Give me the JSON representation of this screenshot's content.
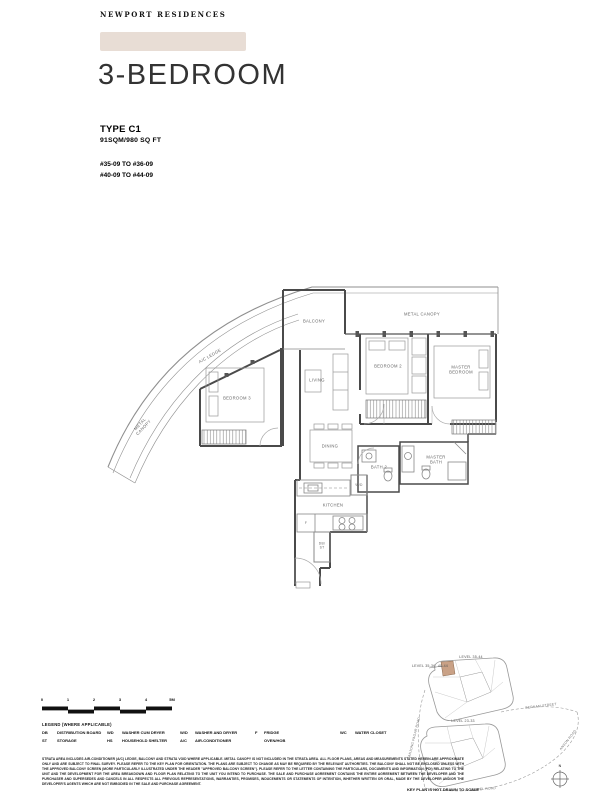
{
  "brand": {
    "logo": "NEWPORT RESIDENCES"
  },
  "header": {
    "title": "3-BEDROOM",
    "type_label": "TYPE C1",
    "area": "91SQM/980 SQ FT",
    "unit_range_1": "#35-09 TO #36-09",
    "unit_range_2": "#40-09 TO #44-09"
  },
  "plan": {
    "rooms": {
      "balcony": "BALCONY",
      "metal_canopy_top": "METAL CANOPY",
      "ac_ledge": "A/C LEDGE",
      "metal_canopy_left": "METAL CANOPY",
      "living": "LIVING",
      "bedroom_3": "BEDROOM 3",
      "bedroom_2": "BEDROOM 2",
      "master_bedroom": "MASTER BEDROOM",
      "dining": "DINING",
      "bath_2": "BATH 2",
      "master_bath": "MASTER BATH",
      "kitchen": "KITCHEN",
      "washer_dryer": "W/D",
      "fridge": "F",
      "db_st": "DB/ ST"
    }
  },
  "key_plan": {
    "level_top": "LEVEL 35-44",
    "level_highlight": "LEVEL 35-36, 40-44",
    "level_bottom": "LEVEL 23-33",
    "road_bernam": "BERNAM STREET",
    "road_anson": "ANSON ROAD",
    "road_keppel": "KEPPEL ROAD",
    "road_tanjong": "TANJONG PAGAR ROAD",
    "compass": "N",
    "caption": "KEY PLAN IS NOT DRAWN TO SCALE"
  },
  "scale_bar": {
    "ticks": [
      "0",
      "1",
      "2",
      "3",
      "4",
      "5M"
    ]
  },
  "legend": {
    "title": "LEGEND (WHERE APPLICABLE)",
    "entries": [
      {
        "abbr": "DB",
        "label": "DISTRIBUTION BOARD"
      },
      {
        "abbr": "ST",
        "label": "STORAGE"
      },
      {
        "abbr": "WD",
        "label": "WASHER CUM DRYER"
      },
      {
        "abbr": "HS",
        "label": "HOUSEHOLD SHELTER"
      },
      {
        "abbr": "W/D",
        "label": "WASHER AND DRYER"
      },
      {
        "abbr": "A/C",
        "label": "AIR-CONDITIONER"
      },
      {
        "abbr": "F",
        "label": "FRIDGE"
      },
      {
        "abbr": "",
        "label": "OVEN/HOB"
      },
      {
        "abbr": "WC",
        "label": "WATER CLOSET"
      }
    ]
  },
  "disclaimer": {
    "text": "STRATA AREA INCLUDES AIR-CONDITIONER (A/C) LEDGE, BALCONY AND STRATA VOID WHERE APPLICABLE. METAL CANOPY IS NOT INCLUDED IN THE STRATA AREA. ALL FLOOR PLANS, AREAS AND MEASUREMENTS STATED HEREIN ARE APPROXIMATE ONLY AND ARE SUBJECT TO FINAL SURVEY. PLEASE REFER TO THE KEY PLAN FOR ORIENTATION. THE PLANS ARE SUBJECT TO CHANGE AS MAY BE REQUIRED BY THE RELEVANT AUTHORITIES. THE BALCONY SHALL NOT BE ENCLOSED UNLESS WITH THE APPROVED BALCONY SCREEN (MORE PARTICULARLY ILLUSTRATED UNDER THE HEADER \"APPROVED BALCONY SCREEN\"). PLEASE REFER TO THE LETTER CONTAINING THE PARTICULARS, DOCUMENTS AND INFORMATION (PDI) RELATING TO THE UNIT AND THE DEVELOPMENT FOR THE AREA BREAKDOWN AND FLOOR PLAN RELATING TO THE UNIT YOU INTEND TO PURCHASE. THE SALE AND PURCHASE AGREEMENT CONTAINS THE ENTIRE AGREEMENT BETWEEN THE DEVELOPER AND THE PURCHASER AND SUPERSEDES AND CANCELS IN ALL RESPECTS ALL PREVIOUS REPRESENTATIONS, WARRANTIES, PROMISES, INDUCEMENTS OR STATEMENTS OF INTENTION, WHETHER WRITTEN OR ORAL, MADE BY THE DEVELOPER AND/OR THE DEVELOPER'S AGENTS WHICH ARE NOT EMBODIED IN THE SALE AND PURCHASE AGREEMENT."
  },
  "colors": {
    "accent_bar": "#e8ddd5",
    "keyplan_highlight": "#c9a186"
  }
}
